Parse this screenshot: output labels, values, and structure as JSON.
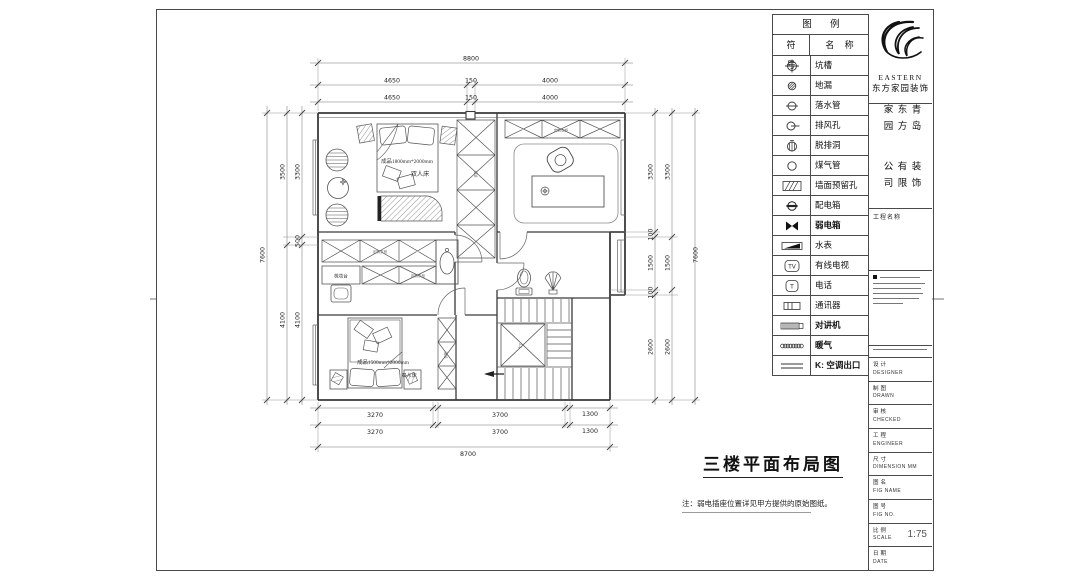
{
  "sheet": {
    "plan_title": "三楼平面布局图",
    "note": "注：弱电插座位置详见甲方提供的原始图纸。"
  },
  "legend": {
    "title": "图 例",
    "col_symbol": "符 号",
    "col_name": "名 称",
    "rows": [
      {
        "icon": "pit-marker-icon",
        "name": "坑槽"
      },
      {
        "icon": "floor-drain-icon",
        "name": "地漏"
      },
      {
        "icon": "downspout-icon",
        "name": "落水管"
      },
      {
        "icon": "exhaust-vent-icon",
        "name": "排风孔"
      },
      {
        "icon": "hood-vent-icon",
        "name": "脱排洞"
      },
      {
        "icon": "gas-pipe-icon",
        "name": "煤气管"
      },
      {
        "icon": "wall-reserved-hole-icon",
        "name": "墙面预留孔"
      },
      {
        "icon": "power-box-icon",
        "name": "配电箱"
      },
      {
        "icon": "weak-current-box-icon",
        "name": "弱电箱"
      },
      {
        "icon": "water-meter-icon",
        "name": "水表"
      },
      {
        "icon": "cable-tv-icon",
        "name": "有线电视",
        "glyph": "TV"
      },
      {
        "icon": "telephone-icon",
        "name": "电话",
        "glyph": "T"
      },
      {
        "icon": "communicator-icon",
        "name": "通讯器"
      },
      {
        "icon": "intercom-icon",
        "name": "对讲机"
      },
      {
        "icon": "radiator-icon",
        "name": "暖气"
      },
      {
        "icon": "ac-outlet-icon",
        "name": "K: 空调出口"
      }
    ]
  },
  "titleblock": {
    "brand_en": "EASTERN",
    "brand_cn": "东方家园装饰",
    "company_col_right": "青岛东方家园",
    "company_col_left": "装饰有限公司",
    "project_label": "工程名称",
    "rows": [
      {
        "label": "设计",
        "value": "DESIGNER"
      },
      {
        "label": "制图",
        "value": "DRAWN"
      },
      {
        "label": "审核",
        "value": "CHECKED"
      },
      {
        "label": "工程",
        "value": "ENGINEER"
      },
      {
        "label": "尺寸",
        "value": "DIMENSION MM"
      },
      {
        "label": "图名",
        "value": "FIG NAME"
      },
      {
        "label": "图号",
        "value": "FIG NO."
      },
      {
        "label": "比例",
        "value": "SCALE",
        "scale": "1:75"
      },
      {
        "label": "日期",
        "value": "DATE"
      }
    ]
  },
  "plan": {
    "bed1_spec": "成品1800mm*2000mm",
    "bed1_name": "双人床",
    "bed2_spec": "成品1500mm*2000mm",
    "bed2_name": "双人床",
    "dresser": "梳妆台",
    "wardrobe": "定制衣柜",
    "wardrobe_s": "衣柜",
    "stairs_up": "上",
    "dims": {
      "top1": [
        "8800"
      ],
      "top2": [
        "4650",
        "150",
        "4000"
      ],
      "top3": [
        "4650",
        "150",
        "4000"
      ],
      "bottom1": [
        "3270",
        "3700",
        "1300"
      ],
      "bottom2": [
        "3270",
        "3700",
        "1300"
      ],
      "bottom3": [
        "8700"
      ],
      "left_inner": [
        "3300",
        "500",
        "4100"
      ],
      "left_mid": [
        "3500",
        "4100"
      ],
      "left_outer": [
        "7600"
      ],
      "right_inner": [
        "3300",
        "100",
        "1500",
        "100",
        "2600"
      ],
      "right_mid": [
        "3300",
        "1500",
        "2600"
      ],
      "right_outer": [
        "7600"
      ]
    }
  }
}
